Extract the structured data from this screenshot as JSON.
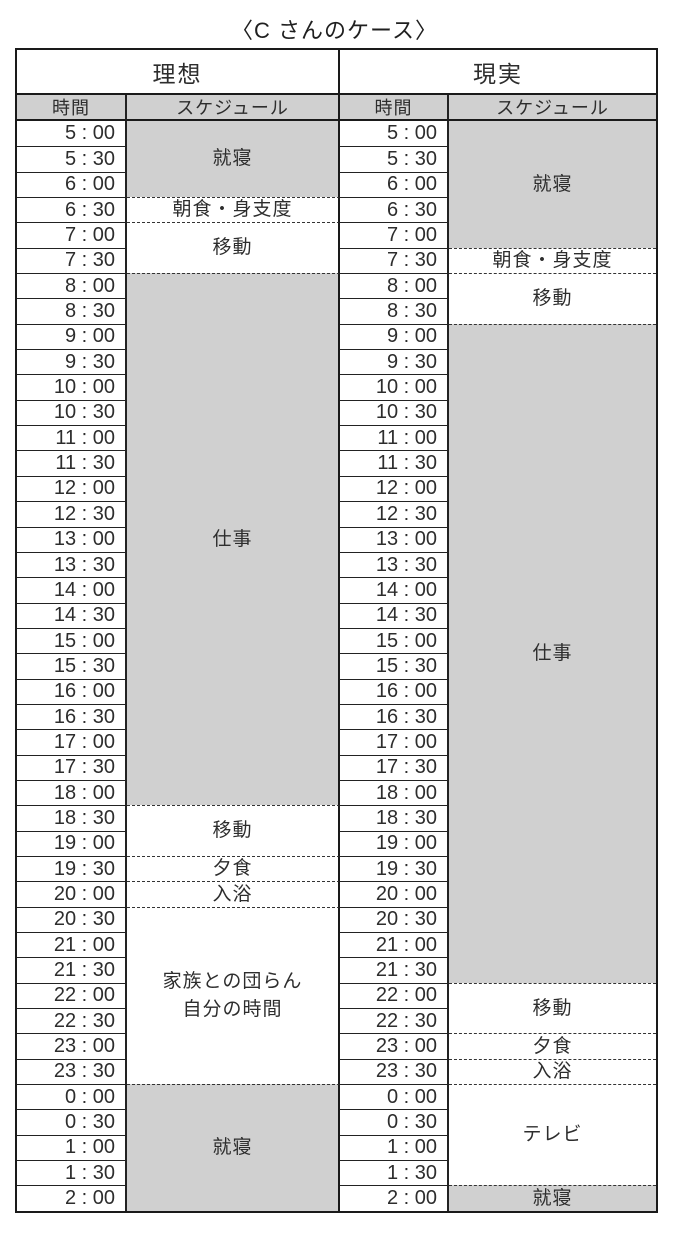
{
  "title": "〈C さんのケース〉",
  "table": {
    "headers": {
      "ideal": "理想",
      "real": "現実"
    },
    "sub_headers": {
      "time": "時間",
      "schedule": "スケジュール"
    },
    "times": [
      "5 : 00",
      "5 : 30",
      "6 : 00",
      "6 : 30",
      "7 : 00",
      "7 : 30",
      "8 : 00",
      "8 : 30",
      "9 : 00",
      "9 : 30",
      "10 : 00",
      "10 : 30",
      "11 : 00",
      "11 : 30",
      "12 : 00",
      "12 : 30",
      "13 : 00",
      "13 : 30",
      "14 : 00",
      "14 : 30",
      "15 : 00",
      "15 : 30",
      "16 : 00",
      "16 : 30",
      "17 : 00",
      "17 : 30",
      "18 : 00",
      "18 : 30",
      "19 : 00",
      "19 : 30",
      "20 : 00",
      "20 : 30",
      "21 : 00",
      "21 : 30",
      "22 : 00",
      "22 : 30",
      "23 : 00",
      "23 : 30",
      "0 : 00",
      "0 : 30",
      "1 : 00",
      "1 : 30",
      "2 : 00"
    ],
    "ideal_blocks": [
      {
        "label": "就寝",
        "rows": 3,
        "shaded": true
      },
      {
        "label": "朝食・身支度",
        "rows": 1,
        "shaded": false
      },
      {
        "label": "移動",
        "rows": 2,
        "shaded": false
      },
      {
        "label": "仕事",
        "rows": 21,
        "shaded": true
      },
      {
        "label": "移動",
        "rows": 2,
        "shaded": false
      },
      {
        "label": "夕食",
        "rows": 1,
        "shaded": false
      },
      {
        "label": "入浴",
        "rows": 1,
        "shaded": false
      },
      {
        "label": "家族との団らん\n自分の時間",
        "rows": 7,
        "shaded": false
      },
      {
        "label": "就寝",
        "rows": 5,
        "shaded": true
      }
    ],
    "real_blocks": [
      {
        "label": "就寝",
        "rows": 5,
        "shaded": true
      },
      {
        "label": "朝食・身支度",
        "rows": 1,
        "shaded": false
      },
      {
        "label": "移動",
        "rows": 2,
        "shaded": false
      },
      {
        "label": "仕事",
        "rows": 26,
        "shaded": true
      },
      {
        "label": "移動",
        "rows": 2,
        "shaded": false
      },
      {
        "label": "夕食",
        "rows": 1,
        "shaded": false
      },
      {
        "label": "入浴",
        "rows": 1,
        "shaded": false
      },
      {
        "label": "テレビ",
        "rows": 4,
        "shaded": false
      },
      {
        "label": "就寝",
        "rows": 1,
        "shaded": true
      }
    ],
    "colors": {
      "shaded_bg": "#d0d0d0",
      "line": "#1a1a1a"
    }
  }
}
